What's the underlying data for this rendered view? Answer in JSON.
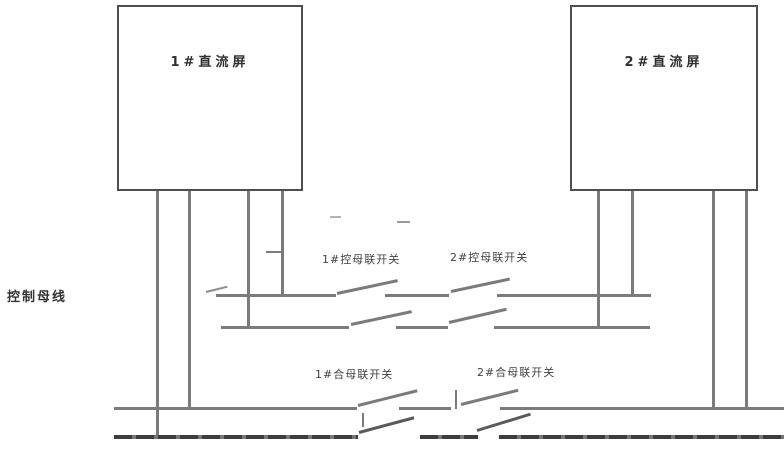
{
  "panels": [
    {
      "label": "1#直流屏"
    },
    {
      "label": "2#直流屏"
    }
  ],
  "bus": {
    "control_bus_label": "控制母线"
  },
  "switches": {
    "ctrl1": {
      "label": "1#控母联开关"
    },
    "ctrl2": {
      "label": "2#控母联开关"
    },
    "close1": {
      "label": "1#合母联开关"
    },
    "close2": {
      "label": "2#合母联开关"
    }
  },
  "colors": {
    "wire": "#7b7b7b",
    "dark_bus": "#3d3d3d",
    "box_border": "#4f4f4f",
    "text": "#3f3f3f",
    "background": "#ffffff"
  }
}
